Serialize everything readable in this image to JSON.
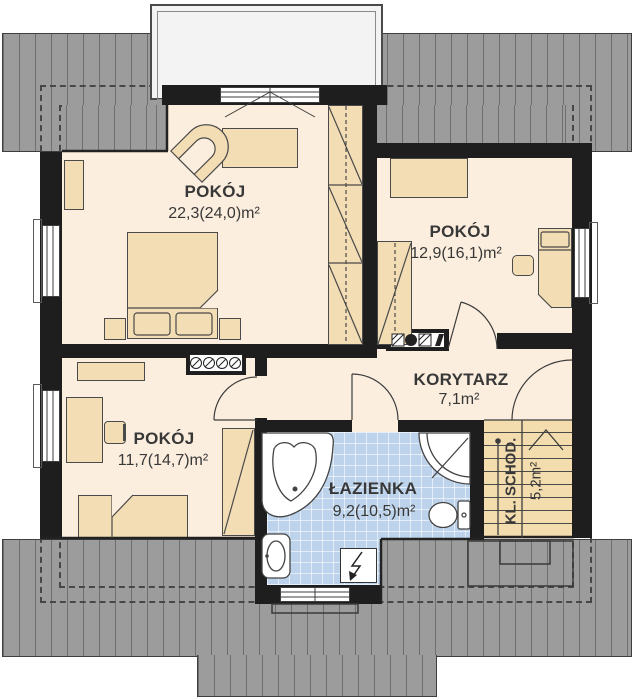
{
  "plan": {
    "type": "floor-plan",
    "rooms": [
      {
        "id": "bedroom-1",
        "name": "POKÓJ",
        "area": "22,3(24,0)m²"
      },
      {
        "id": "bedroom-2",
        "name": "POKÓJ",
        "area": "12,9(16,1)m²"
      },
      {
        "id": "bedroom-3",
        "name": "POKÓJ",
        "area": "11,7(14,7)m²"
      },
      {
        "id": "corridor",
        "name": "KORYTARZ",
        "area": "7,1m²"
      },
      {
        "id": "bathroom",
        "name": "ŁAZIENKA",
        "area": "9,2(10,5)m²"
      },
      {
        "id": "staircase",
        "name": "KL. SCHOD.",
        "area": "5,2m²"
      }
    ],
    "colors": {
      "roof": "#9c9c9c",
      "roof_stripe": "#6f6f6f",
      "wall": "#1e1e1e",
      "floor": "#fceede",
      "furniture": "#f3ddb4",
      "bathroom_floor": "#bdd3ec",
      "stairs": "#f3dcae",
      "line": "#3c3c3c"
    },
    "icons": [
      "bathtub-icon",
      "shower-icon",
      "toilet-icon",
      "sink-icon",
      "electric-point-icon",
      "stairs-up-arrow-icon",
      "chimney-flue-icon",
      "bed-icon",
      "wardrobe-icon",
      "armchair-icon",
      "desk-icon",
      "window-icon",
      "door-arc-icon"
    ]
  }
}
